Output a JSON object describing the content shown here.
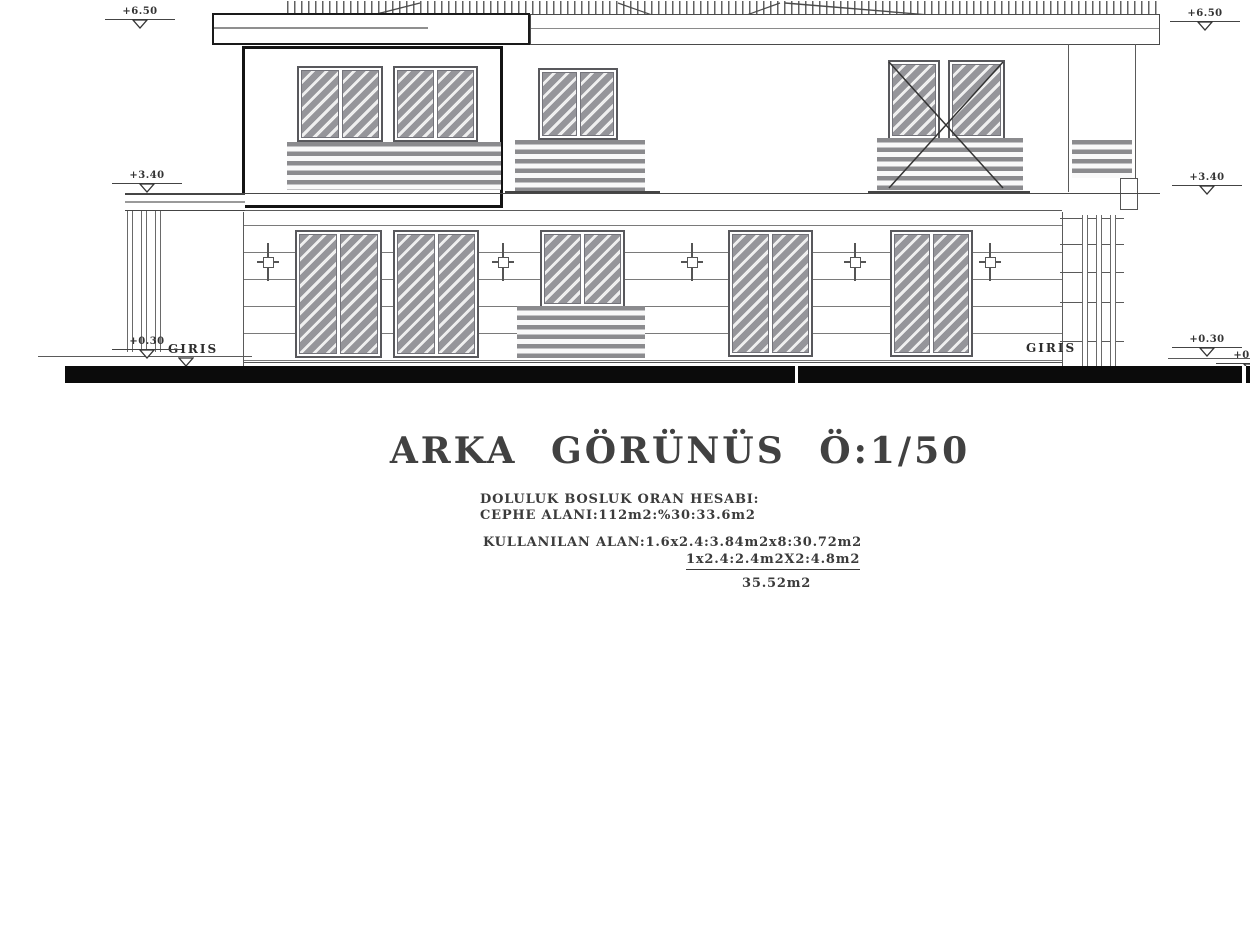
{
  "title_block": {
    "title": "ARKA GÖRÜNÜS Ö:1/50",
    "calc_heading": "DOLULUK BOSLUK ORAN HESABI:",
    "calc_facade_area": "CEPHE ALANI:112m2:%30:33.6m2",
    "calc_used_area_line1": "KULLANILAN ALAN:1.6x2.4:3.84m2x8:30.72m2",
    "calc_used_area_line2": "1x2.4:2.4m2X2:4.8m2",
    "calc_total": "35.52m2"
  },
  "elevation": {
    "entrance_label_left": "GIRIS",
    "entrance_label_right": "GIRIS",
    "markers": [
      {
        "id": "left-roof",
        "label": "+6.50"
      },
      {
        "id": "left-floor",
        "label": "+3.40"
      },
      {
        "id": "left-entry",
        "label": "+0.30"
      },
      {
        "id": "right-roof",
        "label": "+6.50"
      },
      {
        "id": "right-floor",
        "label": "+3.40"
      },
      {
        "id": "right-entry",
        "label": "+0.30"
      },
      {
        "id": "right-grade",
        "label": "+0.00"
      }
    ],
    "scale": "1/50",
    "view": "rear elevation"
  },
  "colors": {
    "line": "#4a4a4a",
    "heavy_line": "#141414",
    "hatch_fill": "#95959a",
    "railing": "#8b8b8e",
    "ground_bar": "#0b0b0b",
    "background": "#ffffff"
  }
}
